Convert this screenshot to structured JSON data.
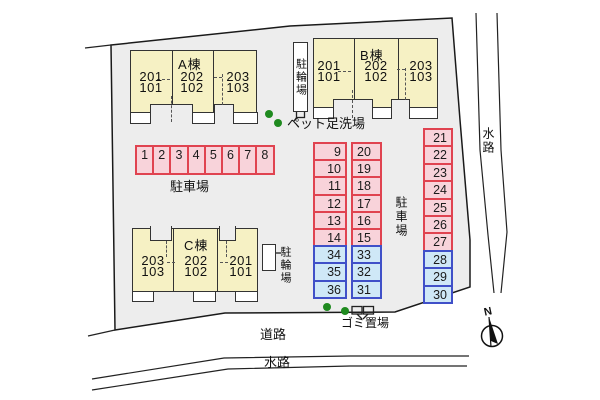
{
  "labels": {
    "bicycle_parking": "駐輪場",
    "pet_foot_wash": "ペット足洗場",
    "parking_lot": "駐車場",
    "garbage_area": "ゴミ置場",
    "road": "道路",
    "waterway": "水路",
    "compass_north": "N"
  },
  "buildings": [
    {
      "name": "A",
      "label": "A棟",
      "units": [
        {
          "upper": "201",
          "lower": "101"
        },
        {
          "upper": "202",
          "lower": "102"
        },
        {
          "upper": "203",
          "lower": "103"
        }
      ]
    },
    {
      "name": "B",
      "label": "B棟",
      "units": [
        {
          "upper": "201",
          "lower": "101"
        },
        {
          "upper": "202",
          "lower": "102"
        },
        {
          "upper": "203",
          "lower": "103"
        }
      ]
    },
    {
      "name": "C",
      "label": "C棟",
      "units": [
        {
          "upper": "203",
          "lower": "103"
        },
        {
          "upper": "202",
          "lower": "102"
        },
        {
          "upper": "201",
          "lower": "101"
        }
      ]
    }
  ],
  "parking": {
    "row_front": {
      "cells": [
        {
          "n": "1",
          "t": "pink"
        },
        {
          "n": "2",
          "t": "pink"
        },
        {
          "n": "3",
          "t": "pink"
        },
        {
          "n": "4",
          "t": "pink"
        },
        {
          "n": "5",
          "t": "pink"
        },
        {
          "n": "6",
          "t": "pink"
        },
        {
          "n": "7",
          "t": "pink"
        },
        {
          "n": "8",
          "t": "pink"
        }
      ]
    },
    "col_inner_left": {
      "cells": [
        {
          "n": "9",
          "t": "pink"
        },
        {
          "n": "10",
          "t": "pink"
        },
        {
          "n": "11",
          "t": "pink"
        },
        {
          "n": "12",
          "t": "pink"
        },
        {
          "n": "13",
          "t": "pink"
        },
        {
          "n": "14",
          "t": "pink"
        },
        {
          "n": "34",
          "t": "blue"
        },
        {
          "n": "35",
          "t": "blue"
        },
        {
          "n": "36",
          "t": "blue"
        }
      ]
    },
    "col_inner_right": {
      "cells": [
        {
          "n": "20",
          "t": "pink"
        },
        {
          "n": "19",
          "t": "pink"
        },
        {
          "n": "18",
          "t": "pink"
        },
        {
          "n": "17",
          "t": "pink"
        },
        {
          "n": "16",
          "t": "pink"
        },
        {
          "n": "15",
          "t": "pink"
        },
        {
          "n": "33",
          "t": "blue"
        },
        {
          "n": "32",
          "t": "blue"
        },
        {
          "n": "31",
          "t": "blue"
        }
      ]
    },
    "col_east": {
      "cells": [
        {
          "n": "21",
          "t": "pink"
        },
        {
          "n": "22",
          "t": "pink"
        },
        {
          "n": "23",
          "t": "pink"
        },
        {
          "n": "24",
          "t": "pink"
        },
        {
          "n": "25",
          "t": "pink"
        },
        {
          "n": "26",
          "t": "pink"
        },
        {
          "n": "27",
          "t": "pink"
        },
        {
          "n": "28",
          "t": "blue"
        },
        {
          "n": "29",
          "t": "blue"
        },
        {
          "n": "30",
          "t": "blue"
        }
      ]
    }
  },
  "colors": {
    "parcel_fill": "#ededed",
    "building_fill": "#f6f1c4",
    "stall_pink_fill": "#f8d3da",
    "stall_pink_border": "#e04350",
    "stall_blue_fill": "#cfe8f7",
    "stall_blue_border": "#4050c8",
    "tree_green": "#1f8a1f"
  }
}
